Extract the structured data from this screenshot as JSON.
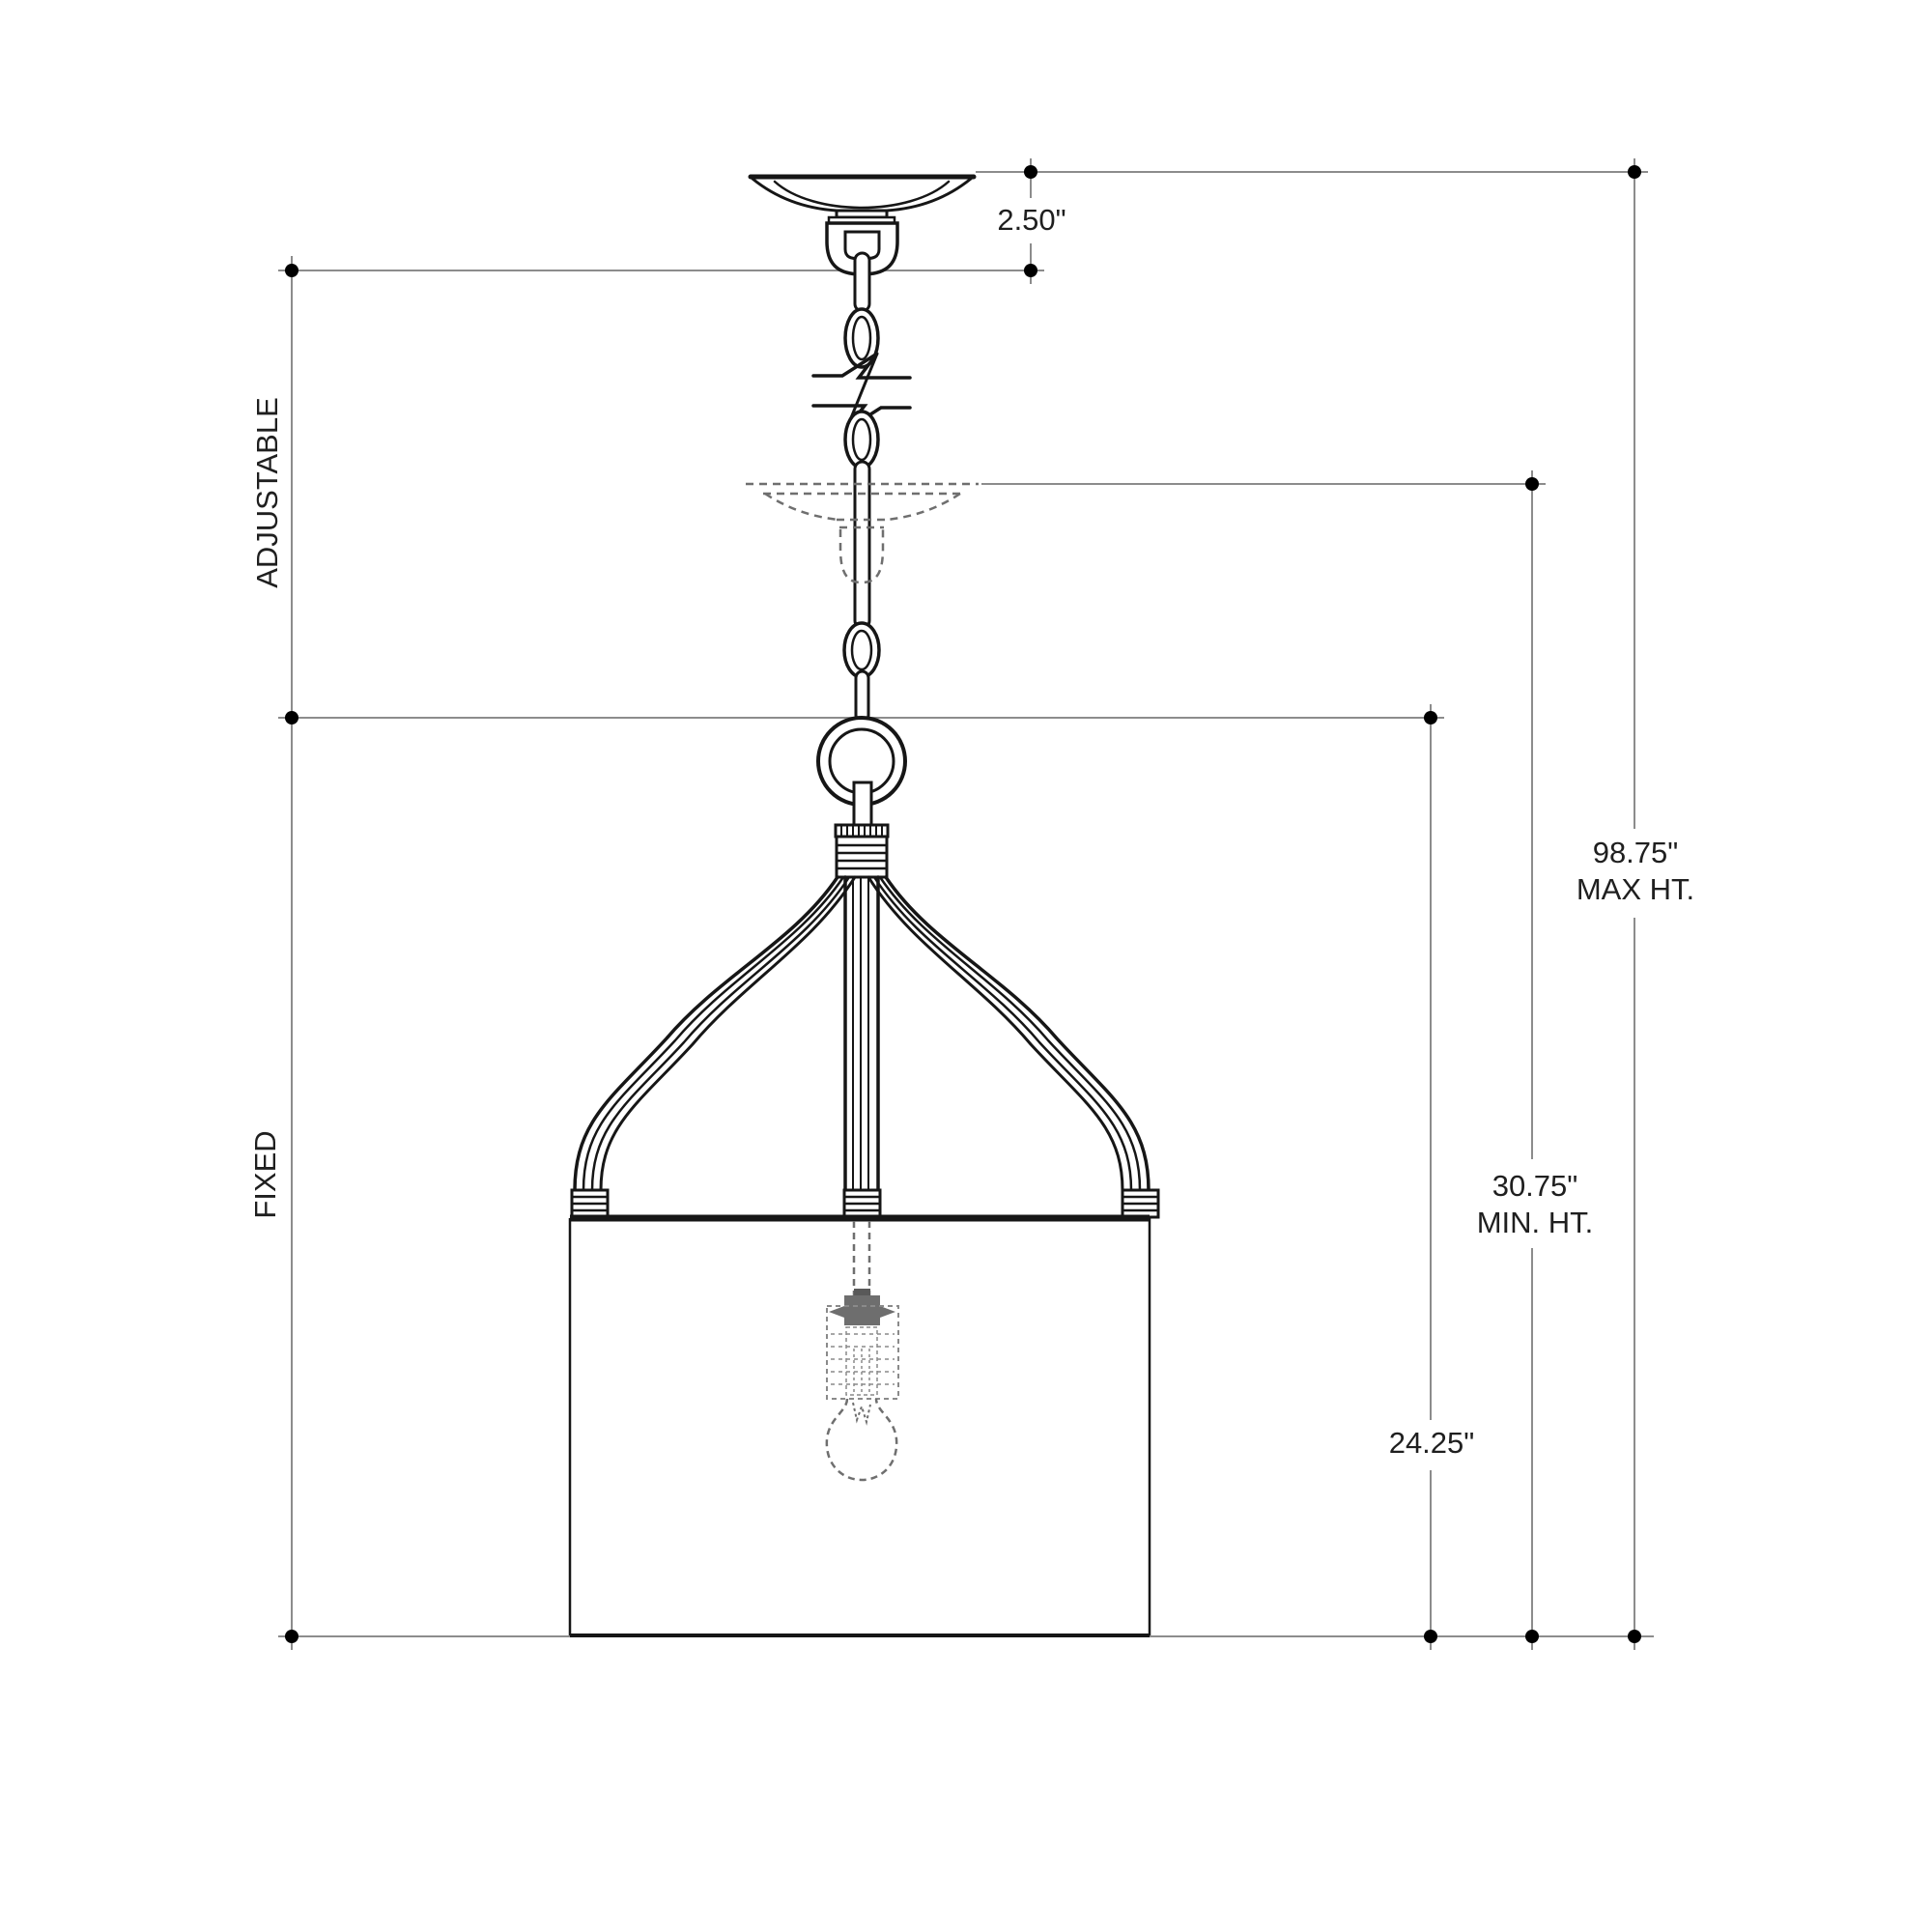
{
  "document": {
    "title": "Pendant light fixture dimension diagram",
    "background_color": "#ffffff",
    "fixture_line_color": "#161616",
    "dimension_line_color": "#8c8c8c",
    "hidden_line_color": "#6f6f6f",
    "socket_fill_color": "#6e6e6e",
    "dot_color": "#000000"
  },
  "dimensions": {
    "canopy": {
      "value": "2.50\""
    },
    "max_height": {
      "value": "98.75\"",
      "label": "MAX HT."
    },
    "min_height": {
      "value": "30.75\"",
      "label": "MIN. HT."
    },
    "fixture_height": {
      "value": "24.25\""
    },
    "adjustable": {
      "label": "ADJUSTABLE"
    },
    "fixed": {
      "label": "FIXED"
    }
  }
}
